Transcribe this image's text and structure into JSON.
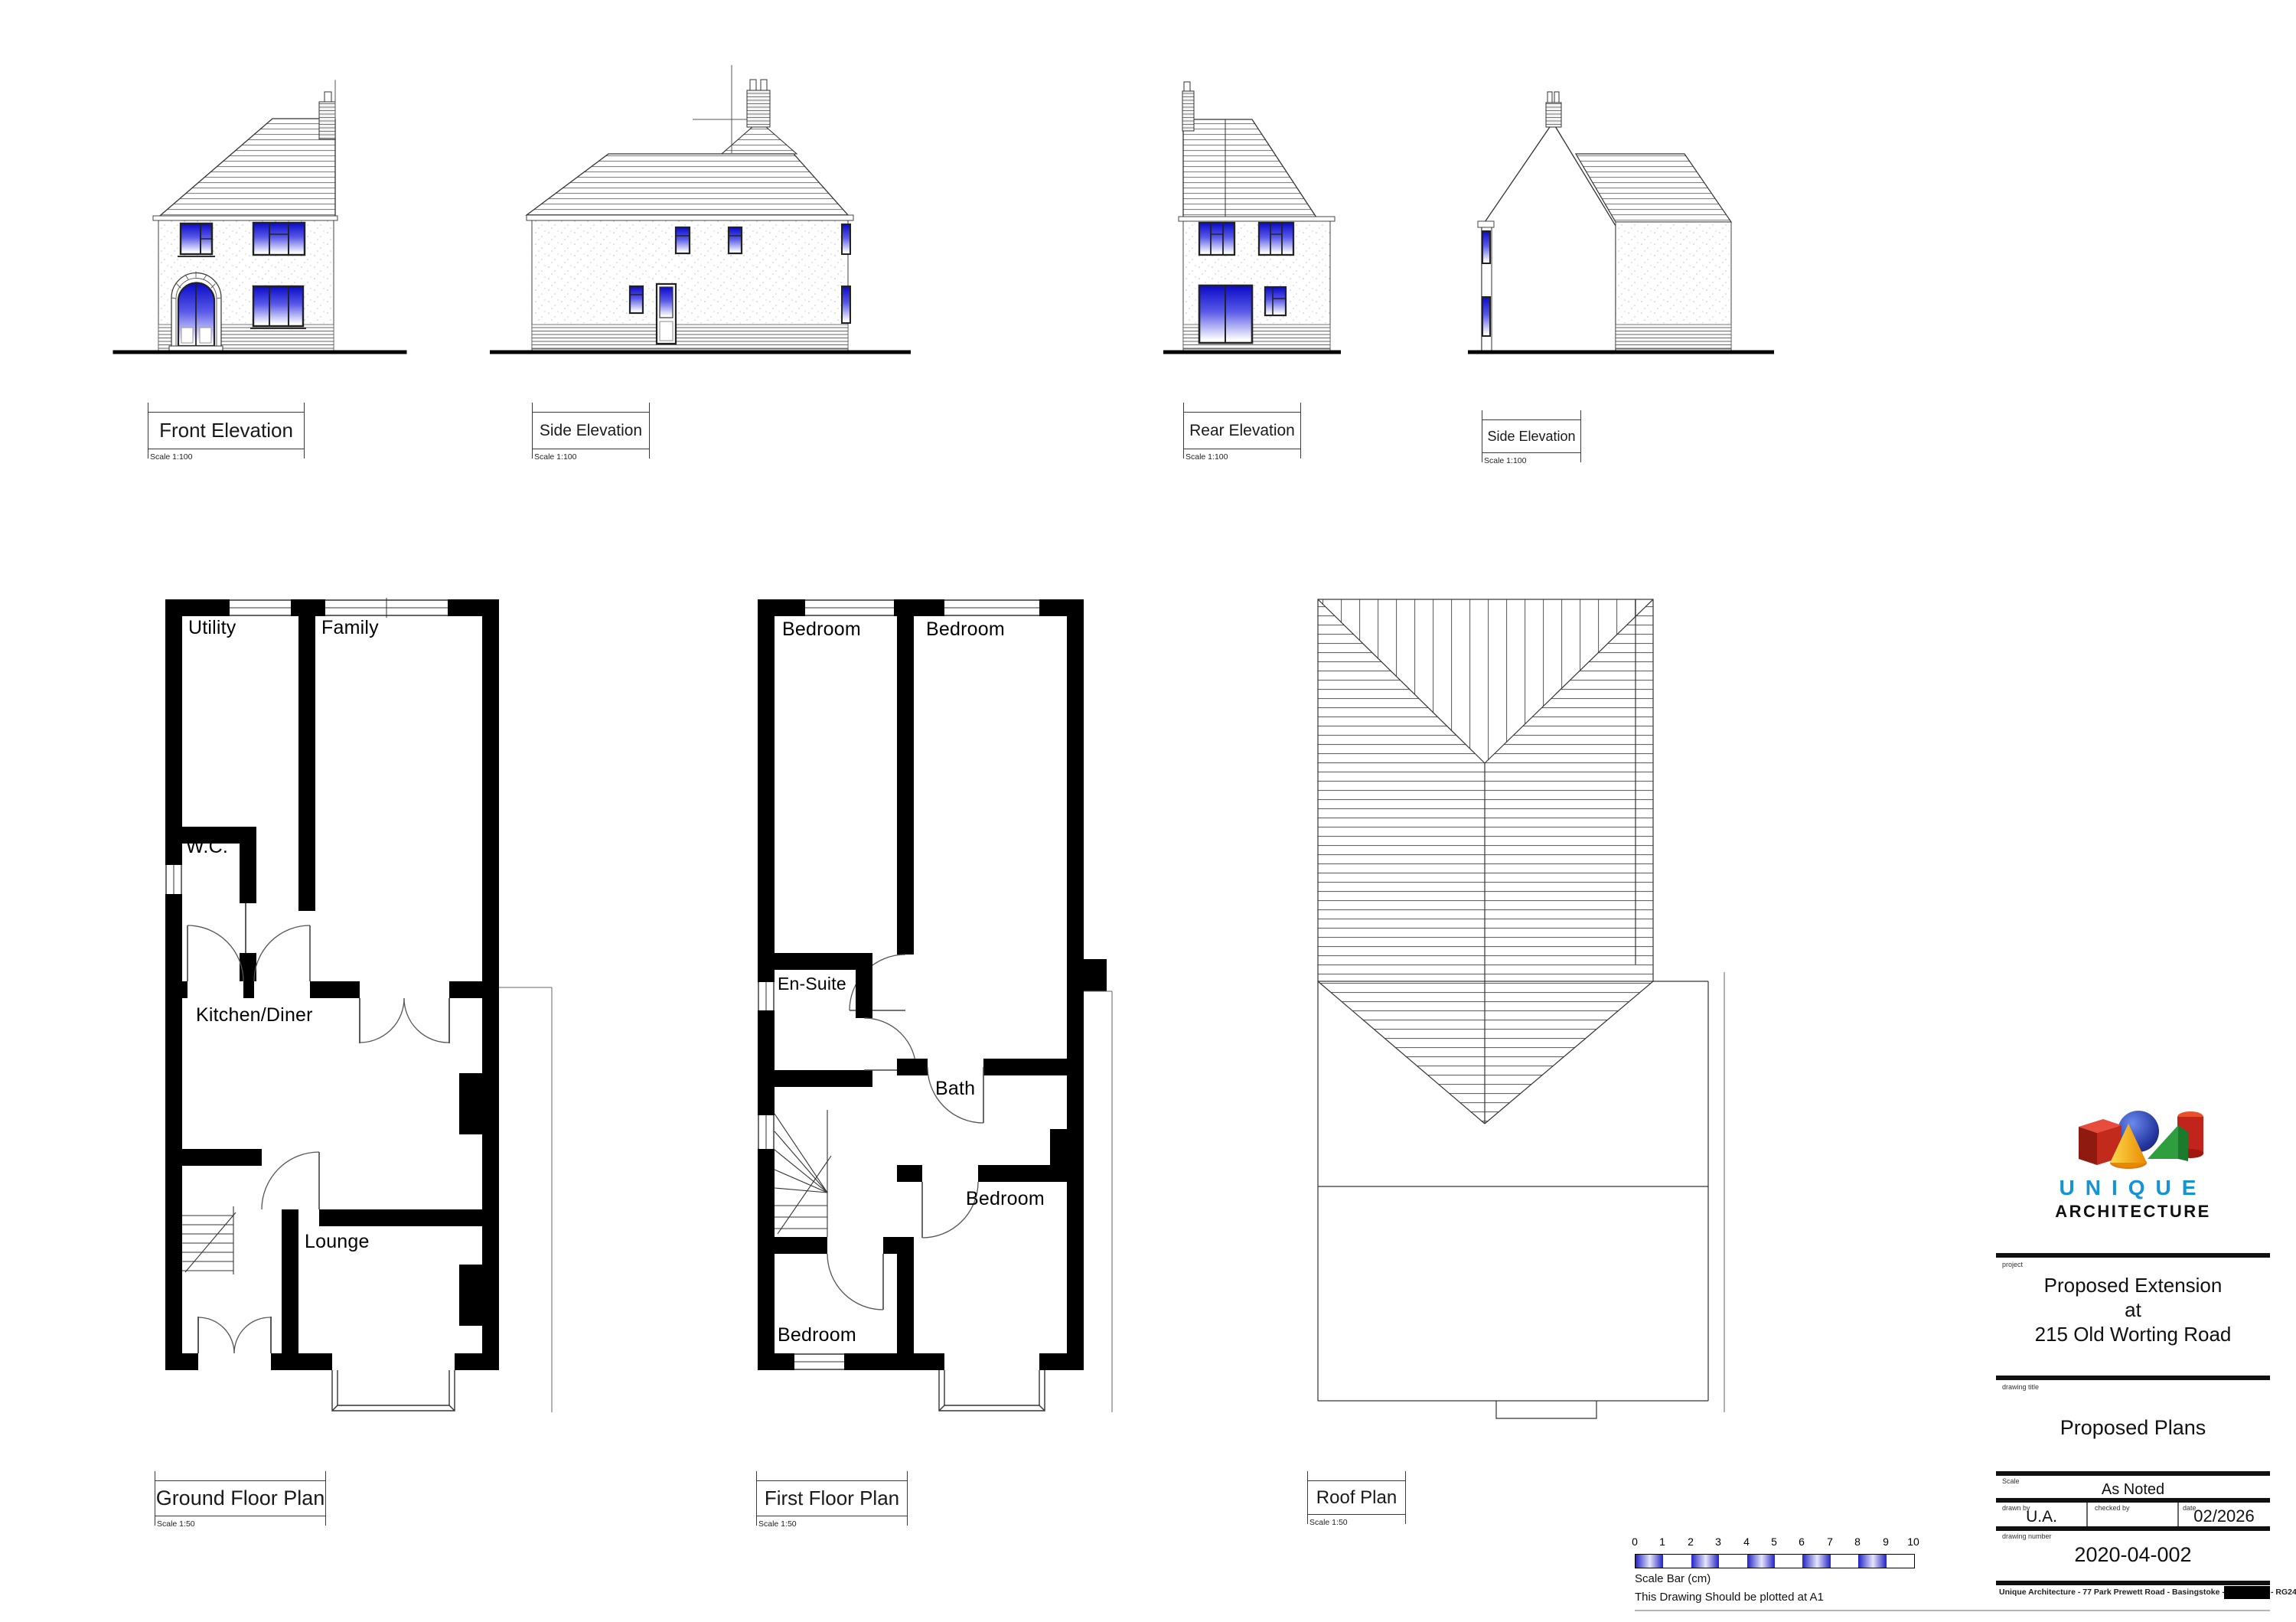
{
  "elevations": {
    "front": {
      "title": "Front Elevation",
      "scale": "Scale 1:100"
    },
    "side": {
      "title": "Side Elevation",
      "scale": "Scale 1:100"
    },
    "rear": {
      "title": "Rear Elevation",
      "scale": "Scale 1:100"
    },
    "side2": {
      "title": "Side Elevation",
      "scale": "Scale 1:100"
    }
  },
  "plans": {
    "ground": {
      "title": "Ground Floor Plan",
      "scale": "Scale 1:50"
    },
    "first": {
      "title": "First Floor Plan",
      "scale": "Scale 1:50"
    },
    "roof": {
      "title": "Roof Plan",
      "scale": "Scale 1:50"
    }
  },
  "rooms": {
    "utility": "Utility",
    "family": "Family",
    "wc": "W.C.",
    "kitchen_diner": "Kitchen/Diner",
    "lounge": "Lounge",
    "bedroom": "Bedroom",
    "ensuite": "En-Suite",
    "bath": "Bath"
  },
  "scale_bar": {
    "ticks": [
      "0",
      "1",
      "2",
      "3",
      "4",
      "5",
      "6",
      "7",
      "8",
      "9",
      "10"
    ],
    "caption": "Scale Bar (cm)",
    "note": "This Drawing Should be plotted at A1"
  },
  "title_block": {
    "logo_line1": "UNIQUE",
    "logo_line2": "ARCHITECTURE",
    "labels": {
      "project": "project",
      "drawing_title": "drawing title",
      "scale": "Scale",
      "drawn_by": "drawn by",
      "checked_by": "checked by",
      "date": "date",
      "drawing_number": "drawing number"
    },
    "project_lines": [
      "Proposed Extension",
      "at",
      "215 Old Worting Road"
    ],
    "drawing_title": "Proposed Plans",
    "scale_value": "As Noted",
    "drawn_by": "U.A.",
    "checked_by": "",
    "date": "02/2026",
    "drawing_number": "2020-04-002",
    "footer": "Unique Architecture - 77 Park Prewett Road - Basingstoke - Hampshire - RG24 9RG"
  },
  "colors": {
    "window_blue": "#1414cc",
    "logo_blue": "#1593d5",
    "wall_black": "#000000",
    "hatch_gray": "#777777"
  }
}
